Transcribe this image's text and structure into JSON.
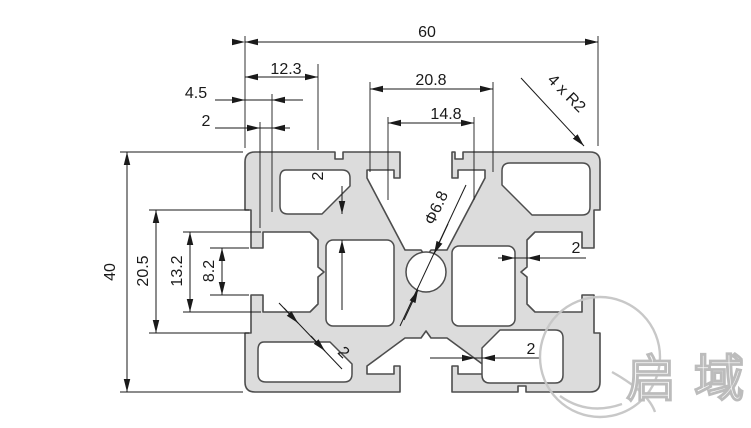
{
  "dims": {
    "total_width": "60",
    "top_left_width": "12.3",
    "top_slot_outer_width": "20.8",
    "top_slot_inner_width": "14.8",
    "left_lip_depth": "4.5",
    "left_lip_thickness": "2",
    "total_height": "40",
    "left_slot_outer_height": "20.5",
    "left_slot_cavity_height": "13.2",
    "left_slot_opening": "8.2",
    "top_web_thickness": "2",
    "right_wall_thickness": "2",
    "bottom_right_wall_thickness": "2",
    "diagonal_web_thickness": "2",
    "center_hole_diameter": "Φ6.8",
    "corner_radius_note": "4 x R2"
  },
  "watermark": {
    "brand_text": "启域"
  },
  "colors": {
    "line": "#1a1a1a",
    "profile_fill": "#dcdcdc",
    "profile_stroke": "#4d4d4d",
    "watermark": "#c6c6c6",
    "background": "#ffffff"
  }
}
